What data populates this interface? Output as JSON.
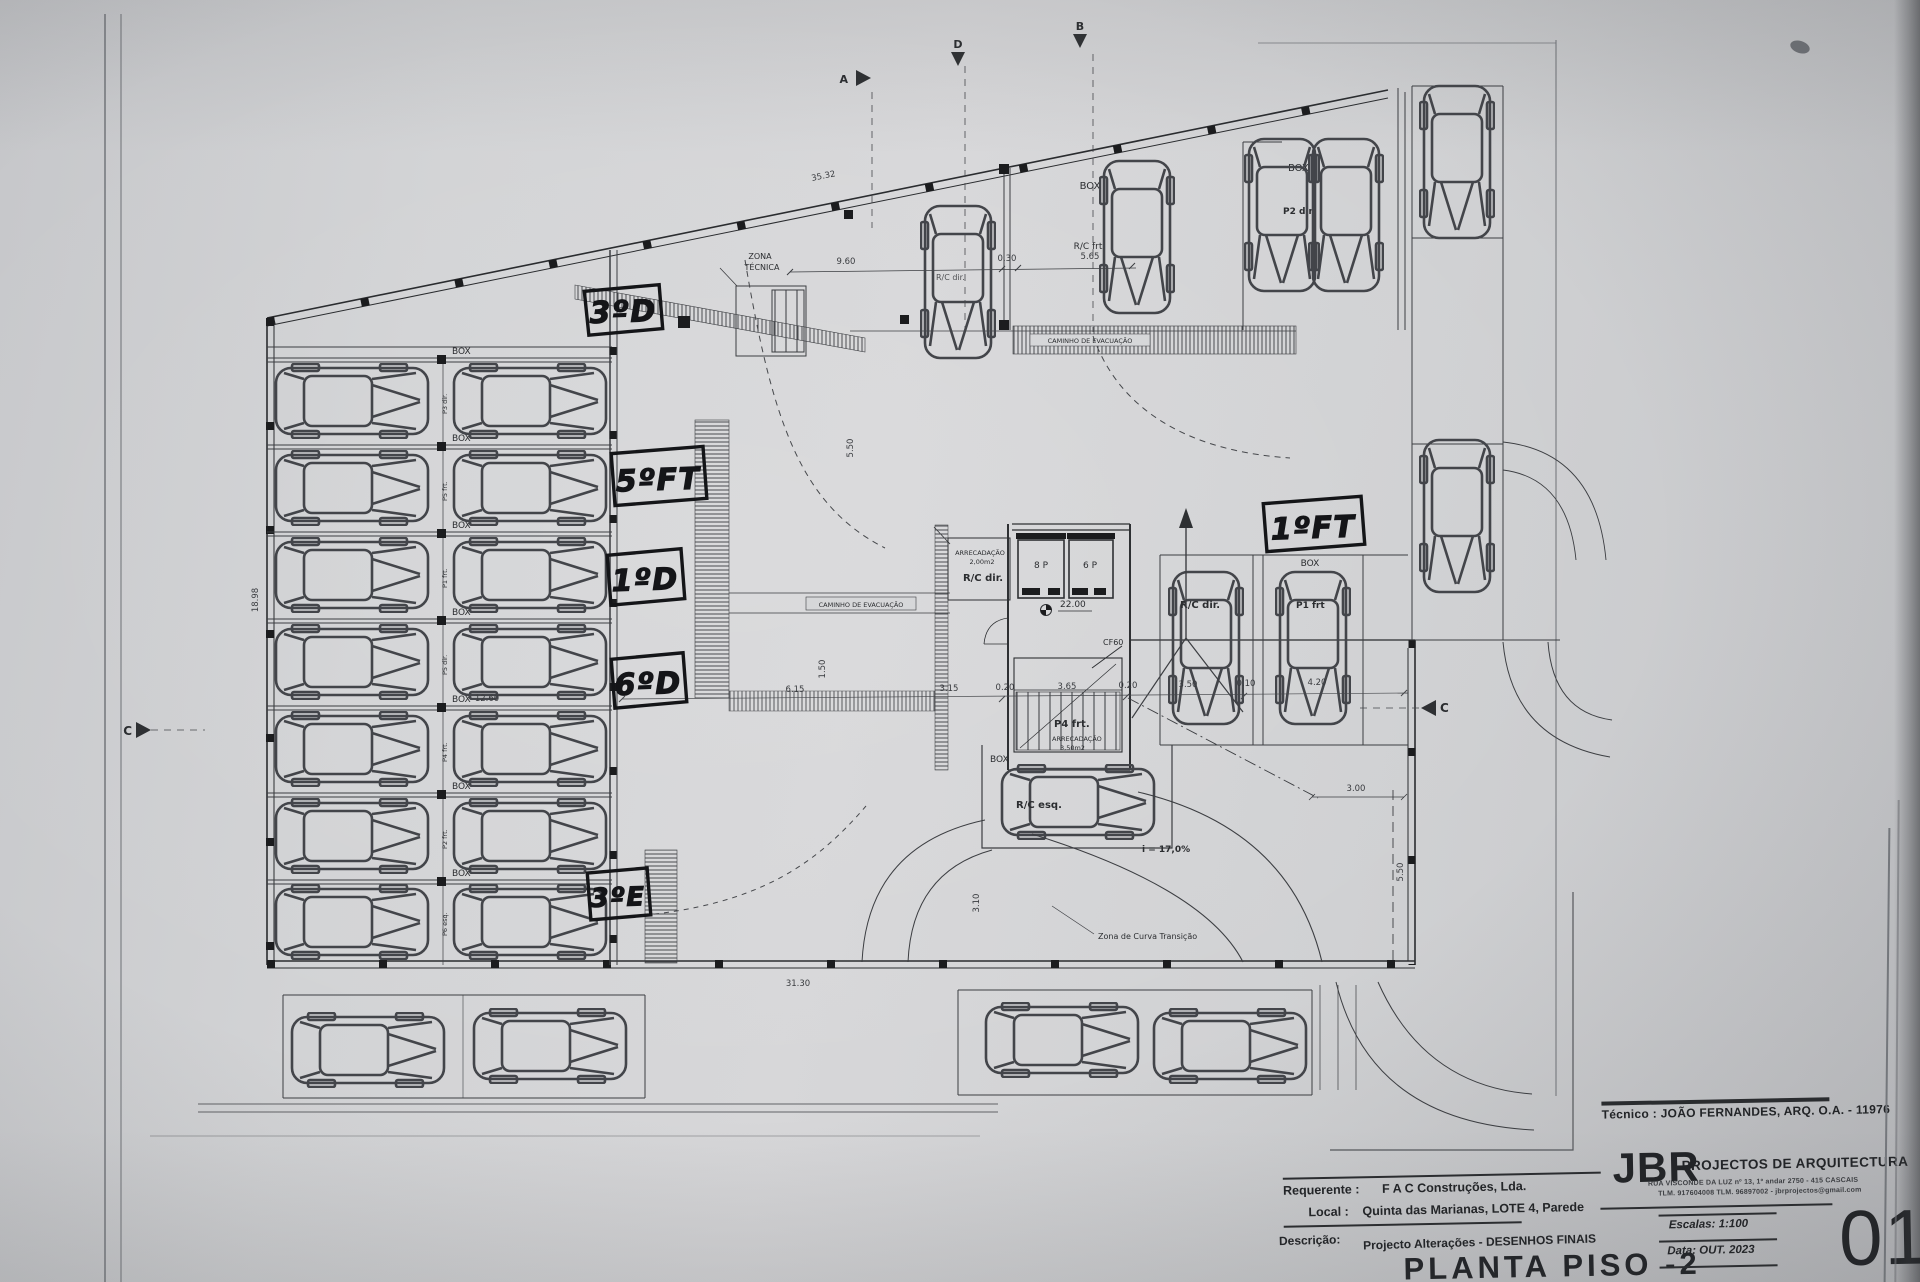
{
  "titleblock": {
    "tecnico": "Técnico : JOÃO FERNANDES, ARQ.   O.A. - 11976",
    "firm_abbr": "JBR",
    "firm_name": "PROJECTOS DE ARQUITECTURA",
    "firm_address": "RUA VISCONDE DA LUZ nº 13, 1º andar   2750 - 415   CASCAIS",
    "firm_contact": "TLM. 917604008  TLM. 96897002 - jbrprojectos@gmail.com",
    "requerente_label": "Requerente :",
    "requerente_value": "F A C  Construções, Lda.",
    "local_label": "Local :",
    "local_value": "Quinta das Marianas, LOTE 4, Parede",
    "descricao_label": "Descrição:",
    "descricao_value": "Projecto Alterações - DESENHOS FINAIS",
    "drawing_title": "PLANTA PISO -2",
    "escalas_label": "Escalas:",
    "escalas_value": "1:100",
    "data_label": "Data:",
    "data_value": "OUT. 2023",
    "sheet_number": "01"
  },
  "handwritten": {
    "h1": "3ºD",
    "h2": "5ºFT",
    "h3": "1ºD",
    "h4": "6ºD",
    "h5": "3ºE",
    "h6": "1ºFT"
  },
  "labels": {
    "box": "BOX",
    "zona_line1": "ZONA",
    "zona_line2": "TÉCNICA",
    "caminho": "CAMINHO  DE  EVACUAÇÃO",
    "rc_dir": "R/C dir.",
    "rc_frt": "R/C frt",
    "rc_esq": "R/C esq.",
    "p2_dir": "P2 dir.",
    "p1_frt": "P1 frt",
    "p4_frt": "P4 frt.",
    "arrecadacao": "ARRECADAÇÃO",
    "area_2": "2,00m2",
    "area_35": "3,50m2",
    "lift_8": "8 P",
    "lift_6": "6 P",
    "level": "22.00",
    "cf60": "CF60",
    "slope": "i = 17,0%",
    "curve": "Zona de Curva Transição"
  },
  "stall_codes": [
    "P3 dir.",
    "P5 frt.",
    "P1 frt.",
    "P5 dir.",
    "P4 frt.",
    "P2 frt.",
    "P6 esq."
  ],
  "dims": {
    "slant": "35.32",
    "d960": "9.60",
    "d030": "0.30",
    "d565": "5.65",
    "v550": "5.50",
    "left": "18.98",
    "d1260": "12.60",
    "d615": "6.15",
    "d315": "3.15",
    "d020a": "0.20",
    "d365": "3.65",
    "d020b": "0.20",
    "d350": "3.50",
    "d010": "0.10",
    "d420": "4.20",
    "d310": "3.10",
    "d150": "1.50",
    "d300": "3.00",
    "v550b": "5.50",
    "d3130": "31.30"
  },
  "markers": {
    "a": "A",
    "d": "D",
    "b": "B",
    "c_left": "C",
    "c_right": "C"
  }
}
